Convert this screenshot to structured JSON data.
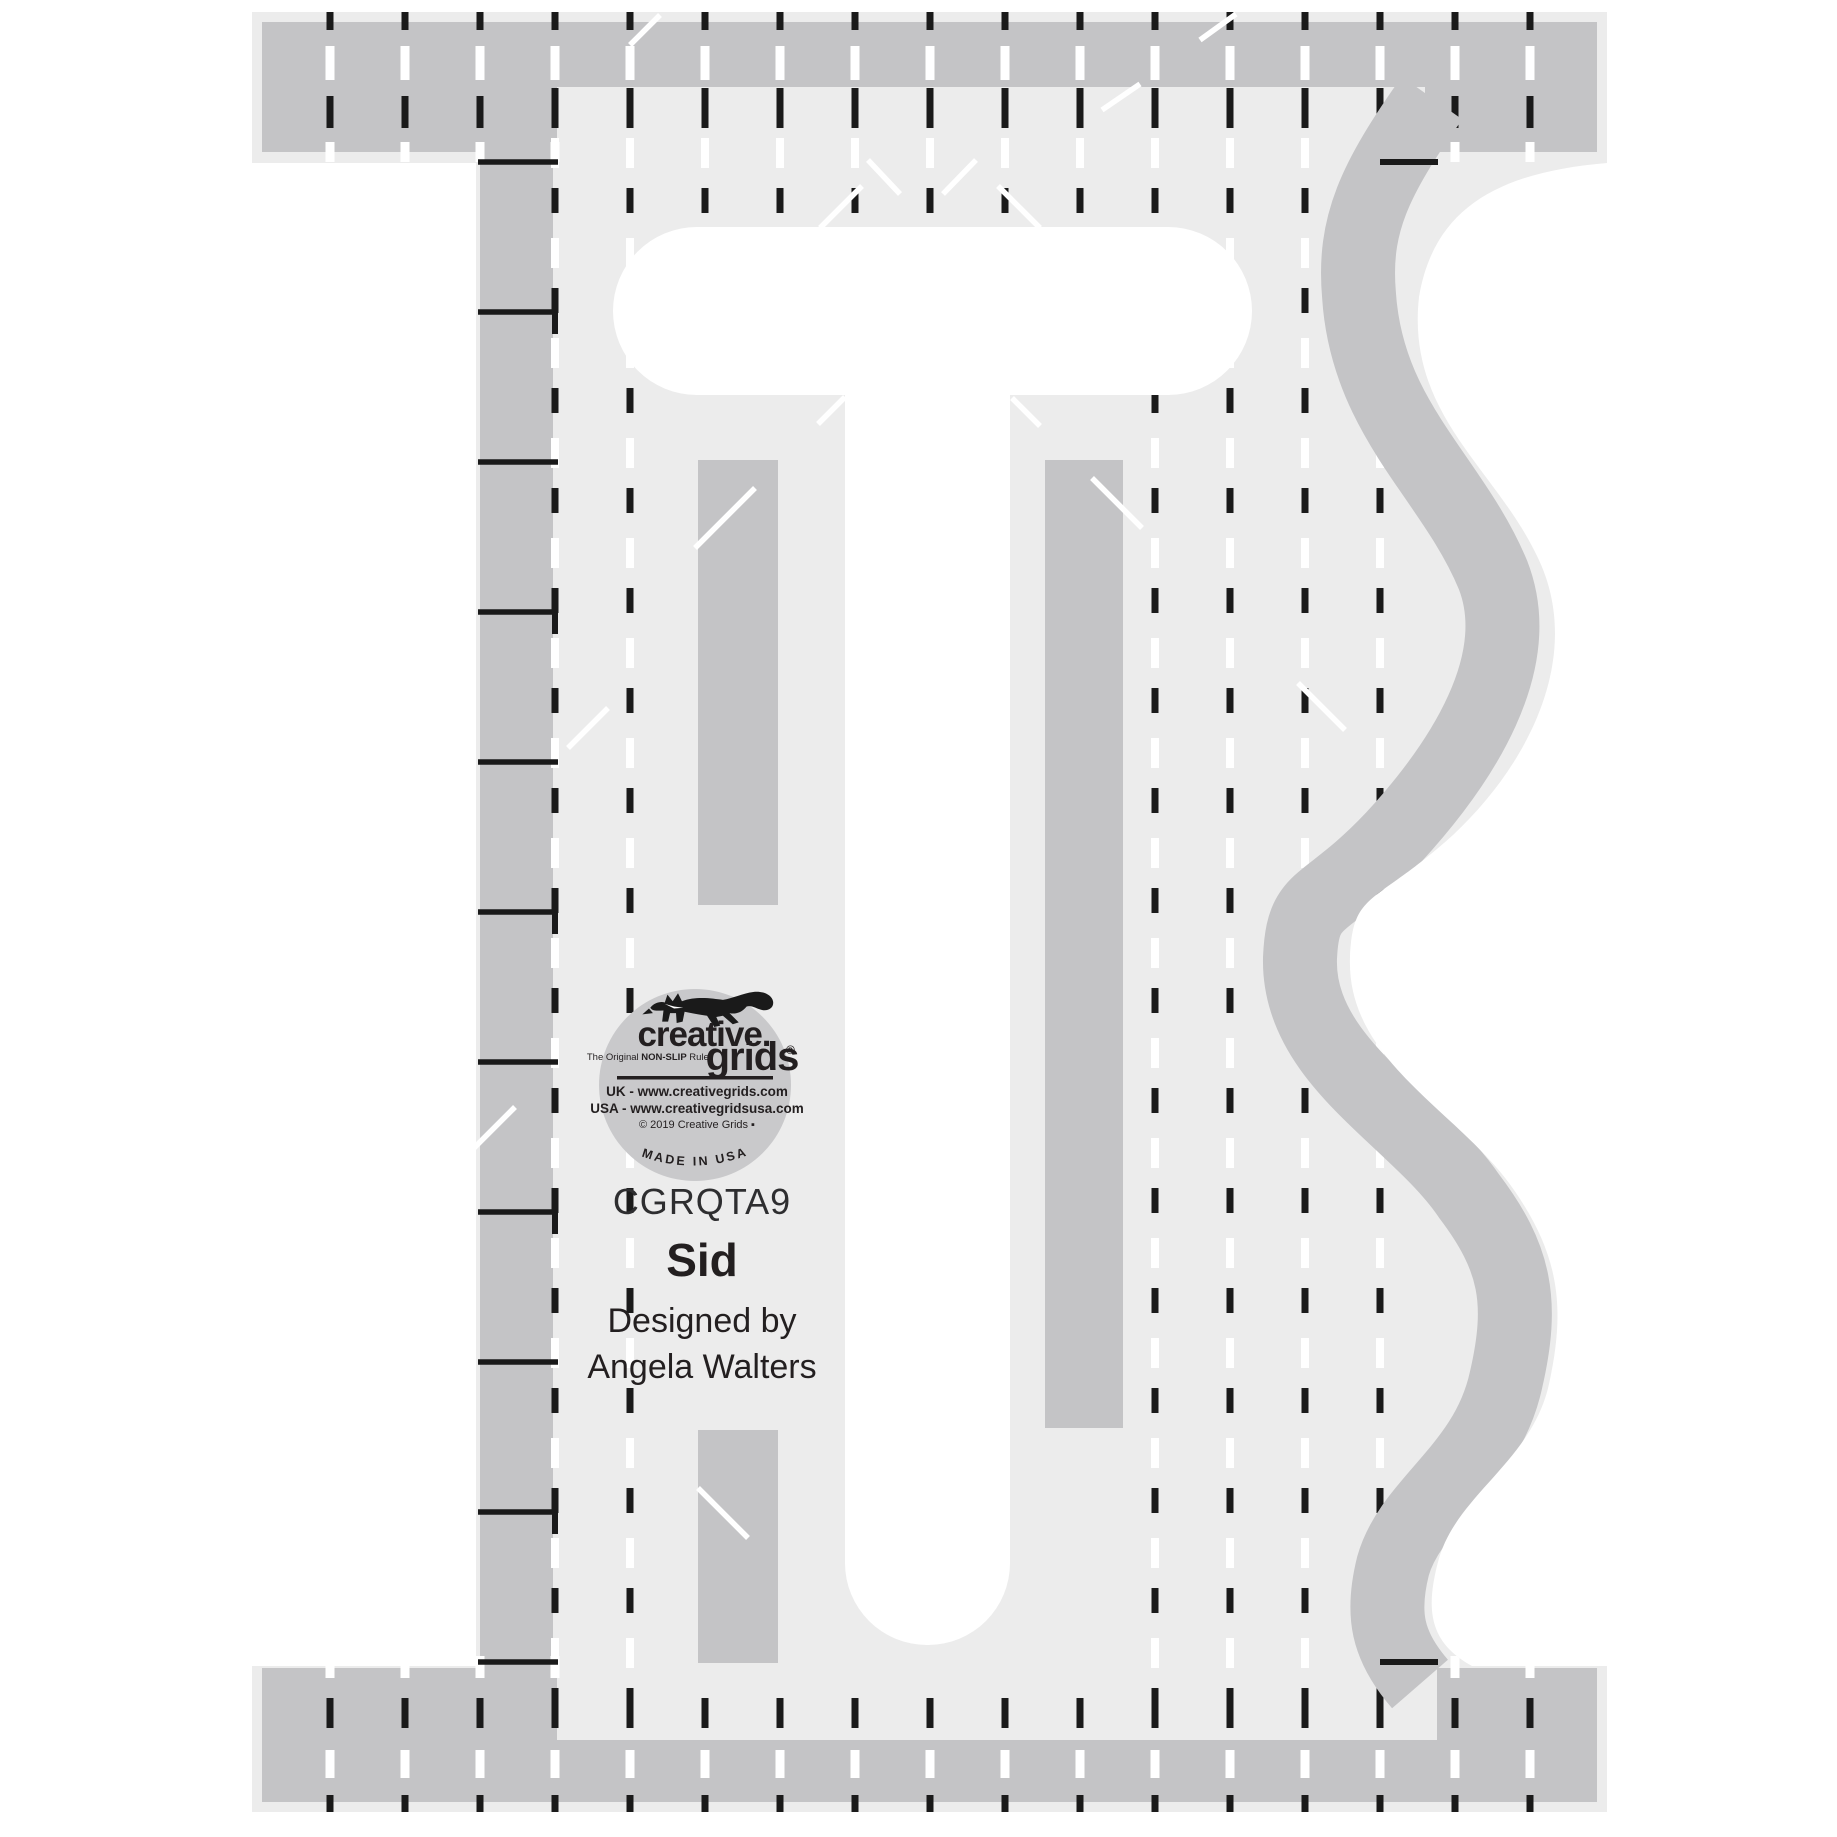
{
  "image": {
    "description": "Product photo of a T-shaped acrylic machine quilting ruler with serpentine right edge",
    "icons": [
      "fox-icon",
      "registered-mark-icon"
    ]
  },
  "logo": {
    "brand_line1": "creative.",
    "brand_line2": "grids",
    "registered_mark": "®",
    "tagline_prefix": "The Original ",
    "tagline_bold": "NON-SLIP",
    "tagline_suffix": " Ruler",
    "url_uk": "UK - www.creativegrids.com",
    "url_usa": "USA - www.creativegridsusa.com",
    "copyright": "© 2019 Creative Grids ▪",
    "made_in": "MADE IN USA"
  },
  "product": {
    "code": "CGRQTA9",
    "name": "Sid",
    "byline_line1": "Designed by",
    "byline_line2": "Angela Walters"
  },
  "colors": {
    "background": "#ffffff",
    "acrylic": "#ececec",
    "print_gray": "#c4c4c6",
    "logo_circle": "#c9c9cb",
    "mark_black": "#1a1a1a",
    "mark_white": "#ffffff",
    "text_black": "#231f20"
  }
}
